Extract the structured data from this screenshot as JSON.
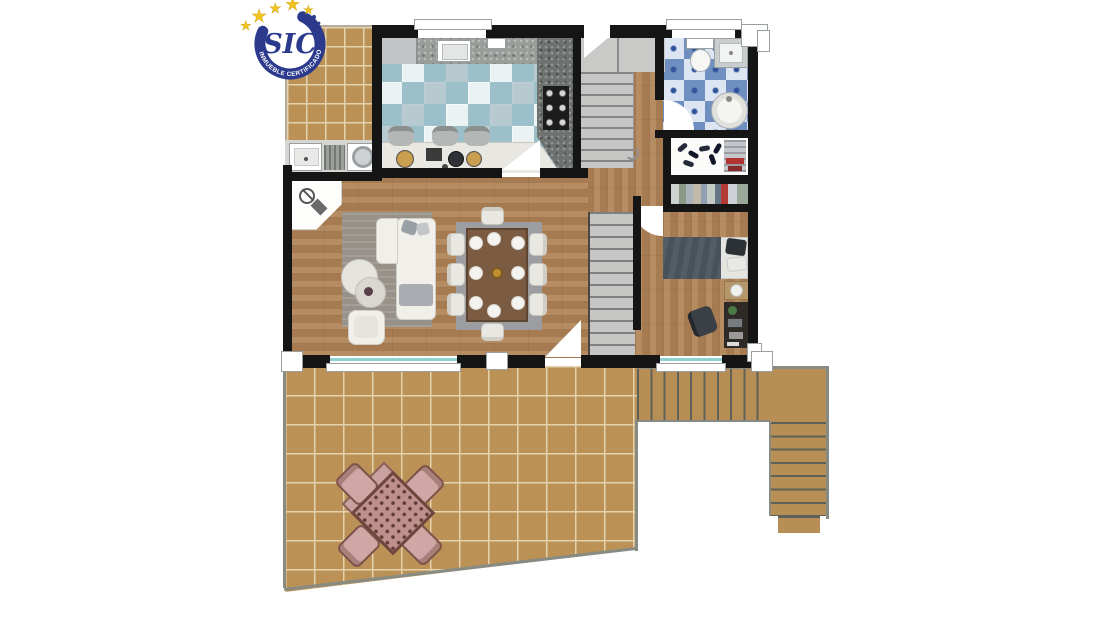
{
  "badge": {
    "title": "SIC",
    "subtitle": "INMUEBLE CERTIFICADO"
  },
  "colors": {
    "badge_navy": "#2b3a8c",
    "badge_gold": "#f2c41e",
    "wall": "#151515",
    "wood": "#b08356",
    "terrace_tile": "#bb9156",
    "terrace_grout": "#e3d2ab",
    "kitchen_tile_dark": "#9cc0c9",
    "kitchen_tile_light": "#eaf2f3",
    "bath_tile_dark": "#6f8fc0",
    "bath_tile_light": "#dde5f2",
    "stair_gray": "#c6c6c4",
    "rug_gray": "#97918a",
    "sofa_white": "#f1efe9",
    "dining_wood": "#7b5c42",
    "bed_dark": "#49525b",
    "outdoor_pink": "#bd8f8d",
    "outdoor_frame": "#6e463c",
    "window_teal": "#8fd0d4"
  }
}
